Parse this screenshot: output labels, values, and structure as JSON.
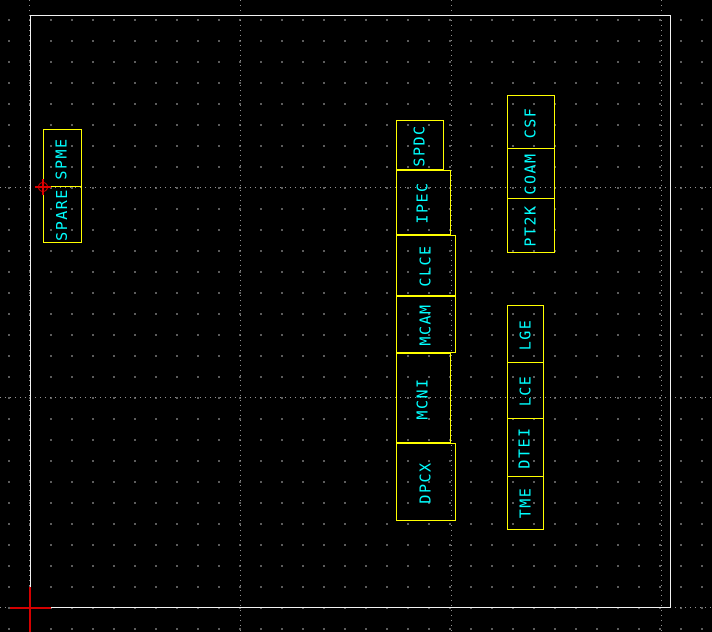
{
  "canvas": {
    "width": 712,
    "height": 632,
    "background": "#000000"
  },
  "colors": {
    "entity_outline": "#ffff00",
    "label_text": "#00ffff",
    "frame": "#f2f2f2",
    "grid_dot": "#6a6a6a",
    "grid_major_line": "#929292",
    "marker_red": "#dd0000"
  },
  "icons": {
    "origin_point": "point-marker-icon",
    "cursor": "crosshair-cursor-icon"
  },
  "blocks": {
    "left": {
      "cells": [
        "SPME",
        "SPARE"
      ]
    },
    "middle": [
      "SPDC",
      "IPEC",
      "CLCE",
      "MCAM",
      "MCNI",
      "DPCX"
    ],
    "right_top": {
      "cells": [
        "CSF",
        "COAM",
        "PT2K"
      ]
    },
    "right_bottom": {
      "cells": [
        "LGE",
        "LCE",
        "DTEI",
        "TME"
      ]
    }
  }
}
